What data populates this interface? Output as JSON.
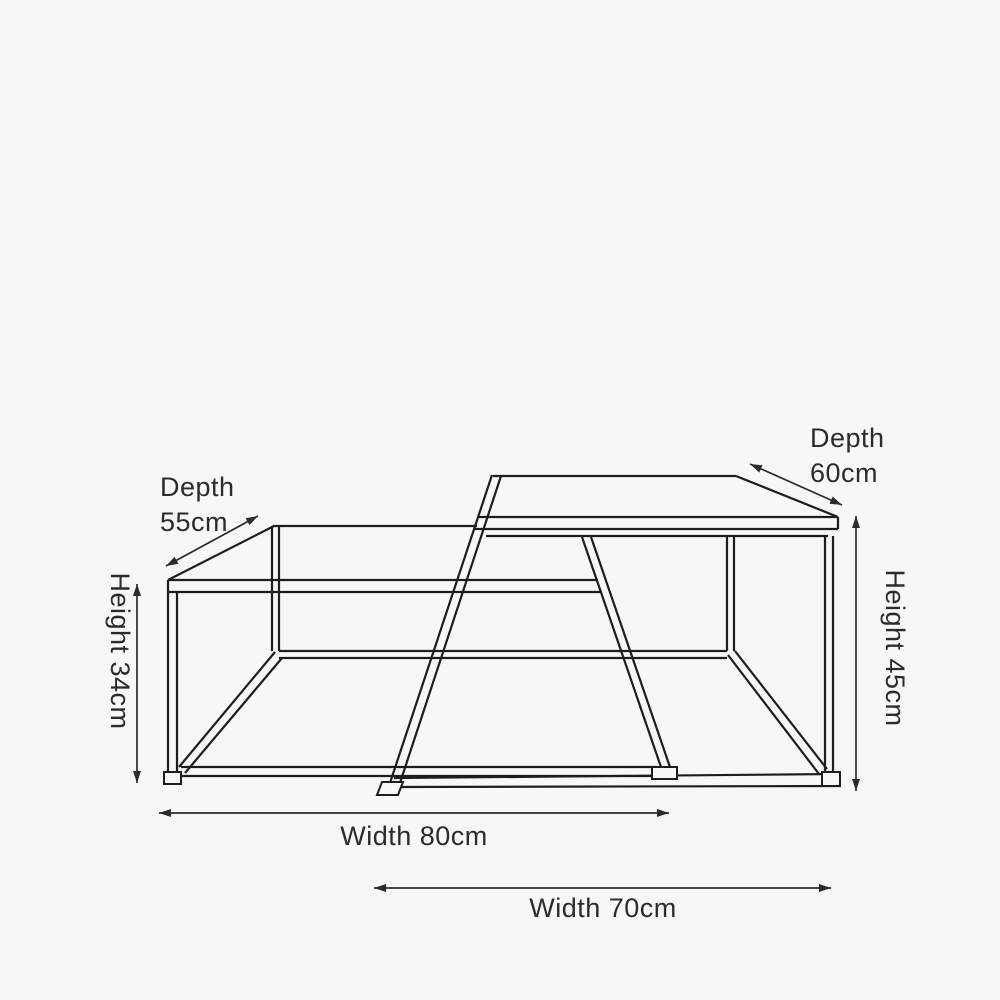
{
  "page": {
    "background_color": "#f7f7f7",
    "line_color": "#1d1d1b",
    "text_color": "#2b2b2b",
    "description": "Dimension line drawing of two nesting coffee tables"
  },
  "annotations": {
    "depth_small": {
      "label": "Depth",
      "value": "55cm"
    },
    "depth_large": {
      "label": "Depth",
      "value": "60cm"
    },
    "height_small": {
      "text": "Height 34cm"
    },
    "height_large": {
      "text": "Height 45cm"
    },
    "width_small": {
      "text": "Width 80cm"
    },
    "width_large": {
      "text": "Width 70cm"
    }
  }
}
